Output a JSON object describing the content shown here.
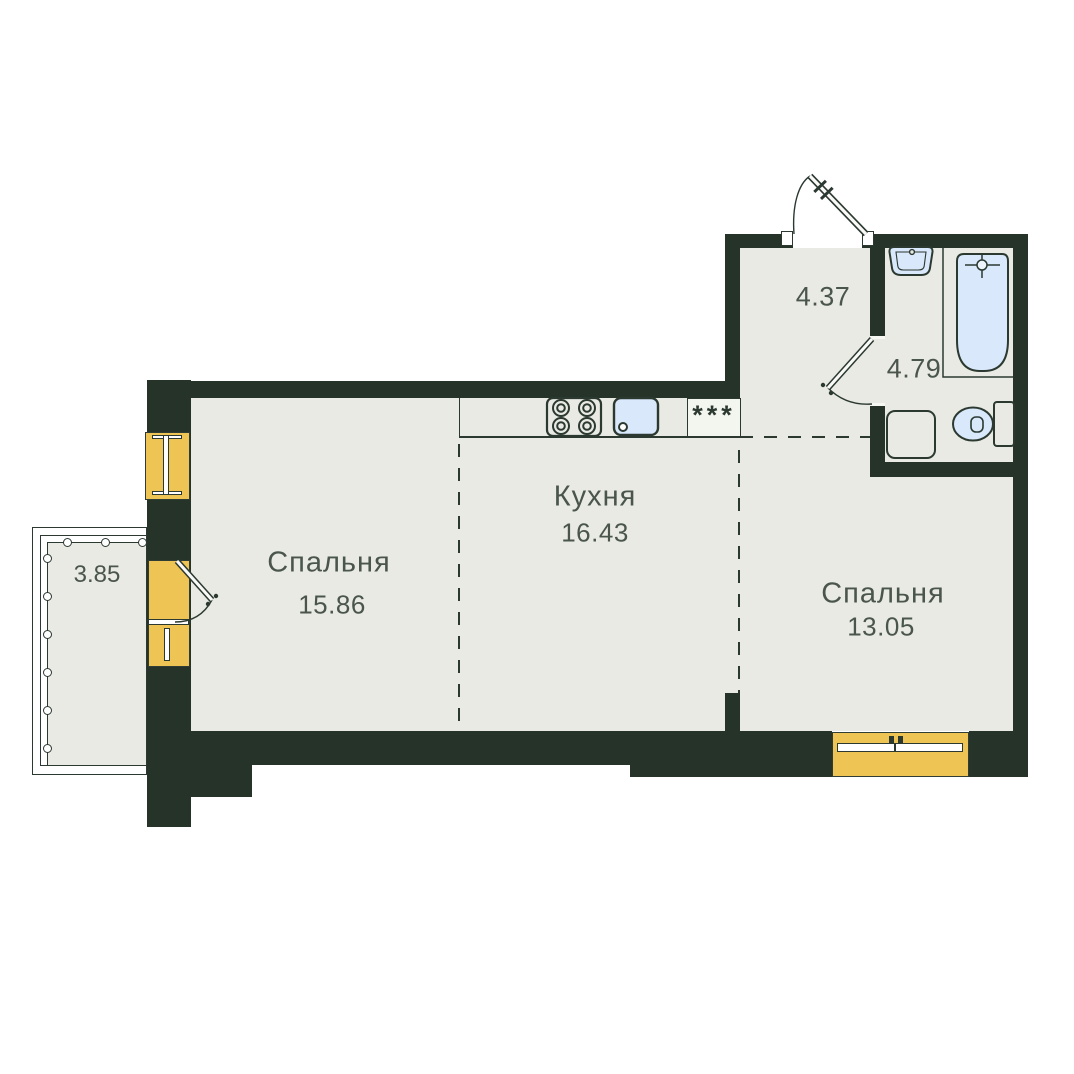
{
  "floorplan": {
    "rooms": {
      "bedroom1": {
        "label": "Спальня",
        "area": "15.86"
      },
      "kitchen": {
        "label": "Кухня",
        "area": "16.43"
      },
      "bedroom2": {
        "label": "Спальня",
        "area": "13.05"
      },
      "hallway": {
        "area": "4.37"
      },
      "bathroom": {
        "area": "4.79"
      },
      "balcony": {
        "area": "3.85"
      }
    },
    "vent_shaft_symbol": "***",
    "icons": {
      "stove": "stove-icon",
      "kitchen_sink": "kitchen-sink-icon",
      "bath_sink": "bath-sink-icon",
      "bathtub": "bathtub-icon",
      "toilet": "toilet-icon",
      "washing_machine": "washing-machine-icon",
      "entrance_door": "entrance-door-icon",
      "interior_door": "interior-door-icon",
      "balcony_door": "balcony-door-icon"
    },
    "colors": {
      "wall": "#253329",
      "room_fill": "#e8eae3",
      "window": "#eec455",
      "fixture_fill": "#d9e8fa",
      "outline": "#2b3931",
      "text": "#4a554c",
      "background": "#ffffff"
    }
  }
}
